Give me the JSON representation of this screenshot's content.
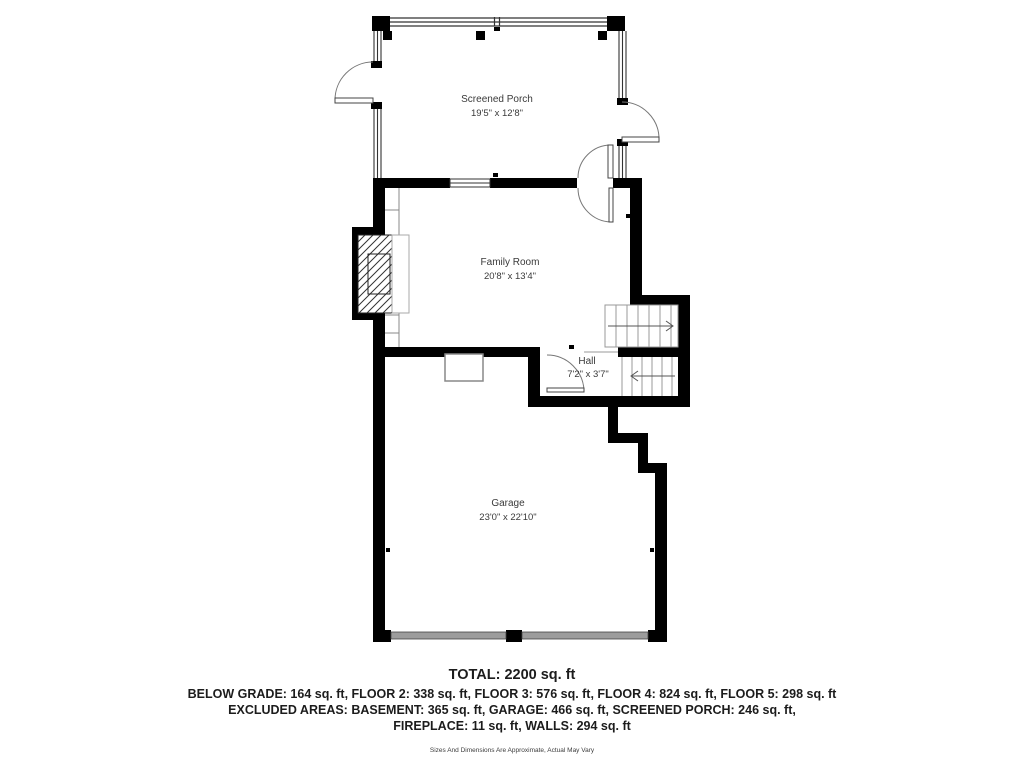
{
  "floor_plan": {
    "rooms": [
      {
        "id": "screened_porch",
        "name": "Screened Porch",
        "dimensions": "19'5\" x 12'8\""
      },
      {
        "id": "family_room",
        "name": "Family Room",
        "dimensions": "20'8\" x 13'4\""
      },
      {
        "id": "hall",
        "name": "Hall",
        "dimensions": "7'2\" x 3'7\""
      },
      {
        "id": "garage",
        "name": "Garage",
        "dimensions": "23'0\" x 22'10\""
      }
    ],
    "summary": {
      "total": "TOTAL: 2200 sq. ft",
      "floors": "BELOW GRADE: 164 sq. ft, FLOOR 2: 338 sq. ft, FLOOR 3: 576 sq. ft, FLOOR 4: 824 sq. ft, FLOOR 5: 298 sq. ft",
      "excluded": "EXCLUDED AREAS: BASEMENT: 365 sq. ft, GARAGE: 466 sq. ft, SCREENED PORCH: 246 sq. ft,",
      "excluded2": "FIREPLACE: 11 sq. ft, WALLS: 294 sq. ft",
      "disclaimer": "Sizes And Dimensions Are Approximate, Actual May Vary"
    },
    "colors": {
      "wall": "#000000",
      "thin_line": "#666666",
      "garage_door_band": "#9c9c9c",
      "label_text": "#3a3a3a",
      "summary_text": "#1c1c1c"
    }
  }
}
